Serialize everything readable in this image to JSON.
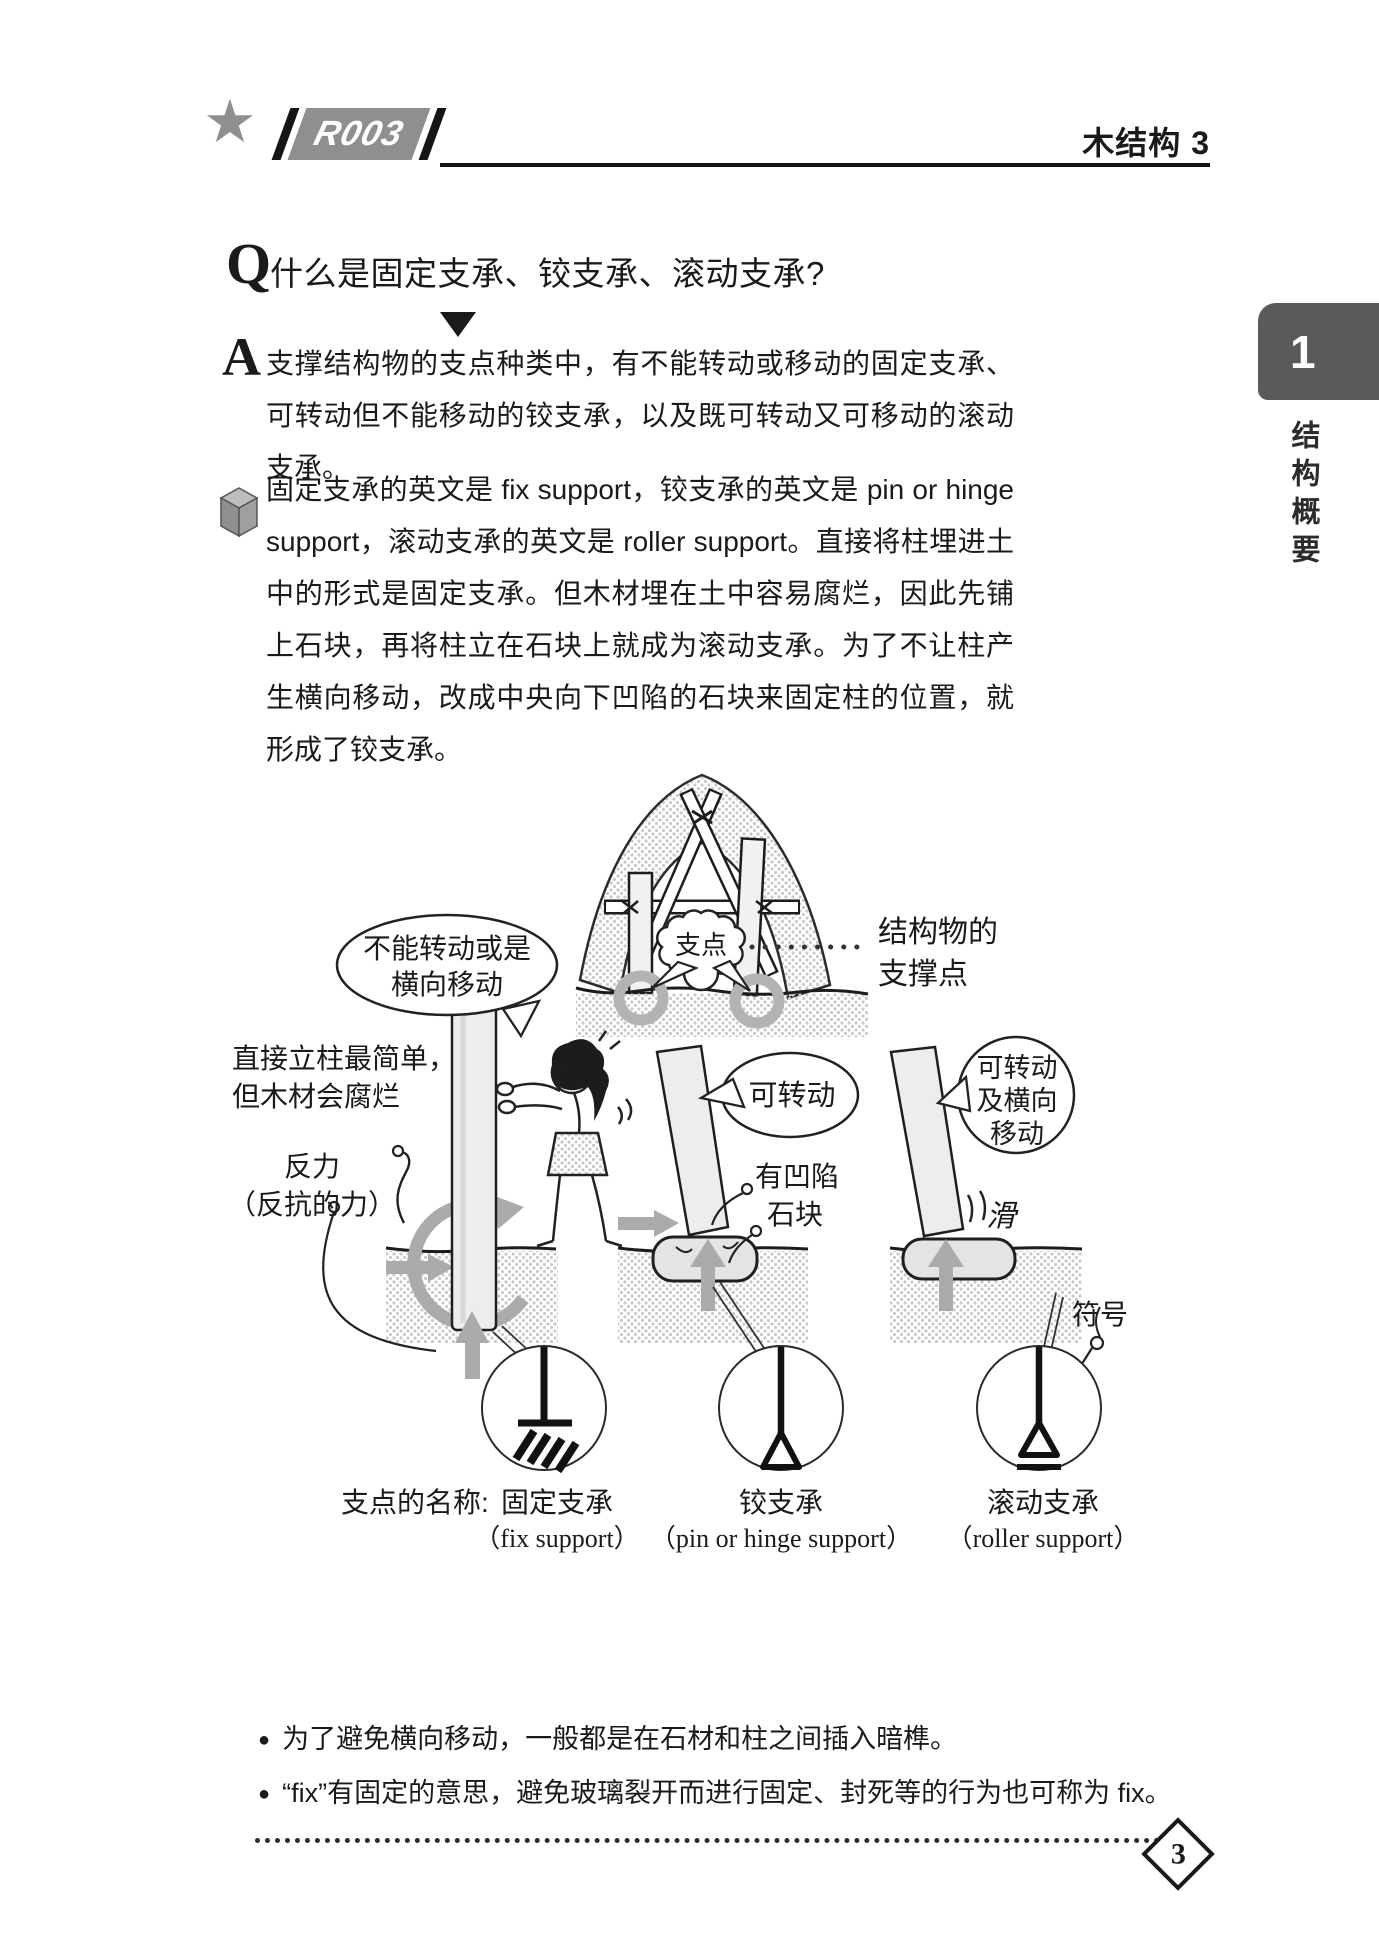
{
  "colors": {
    "badge_gray": "#8f8f8f",
    "tab_gray": "#5a5a5a",
    "ink": "#1a1a1a",
    "halftone": "#c9c9c9",
    "arrow_gray": "#ababab"
  },
  "header": {
    "star": "★",
    "badge": "R003",
    "chapter": "木结构 3"
  },
  "sidebar": {
    "number": "1",
    "label": "结构概要"
  },
  "qa": {
    "q_label": "Q",
    "q_text": "什么是固定支承、铰支承、滚动支承?",
    "a_label": "A",
    "a_text": "支撑结构物的支点种类中，有不能转动或移动的固定支承、可转动但不能移动的铰支承，以及既可转动又可移动的滚动支承。"
  },
  "body": {
    "text": "固定支承的英文是 fix support，铰支承的英文是 pin or hinge support，滚动支承的英文是 roller support。直接将柱埋进土中的形式是固定支承。但木材埋在土中容易腐烂，因此先铺上石块，再将柱立在石块上就成为滚动支承。为了不让柱产生横向移动，改成中央向下凹陷的石块来固定柱的位置，就形成了铰支承。"
  },
  "figure": {
    "fulcrum_bubble": "支点",
    "support_point": [
      "结构物的",
      "支撑点"
    ],
    "no_rotate_bubble": [
      "不能转动或是",
      "横向移动"
    ],
    "pillar_note": [
      "直接立柱最简单，",
      "但木材会腐烂"
    ],
    "reaction": [
      "反力",
      "（反抗的力）"
    ],
    "rotatable_bubble": "可转动",
    "hollow_stone": [
      "有凹陷",
      "石块"
    ],
    "rotate_move_bubble": [
      "可转动",
      "及横向",
      "移动"
    ],
    "slide_label": "滑",
    "symbol_label": "符号",
    "names_prefix": "支点的名称:",
    "supports": [
      {
        "name": "固定支承",
        "en": "（fix support）"
      },
      {
        "name": "铰支承",
        "en": "（pin or hinge support）"
      },
      {
        "name": "滚动支承",
        "en": "（roller support）"
      }
    ]
  },
  "notes": {
    "items": [
      "为了避免横向移动，一般都是在石材和柱之间插入暗榫。",
      "“fix”有固定的意思，避免玻璃裂开而进行固定、封死等的行为也可称为 fix。"
    ]
  },
  "page_number": "3"
}
